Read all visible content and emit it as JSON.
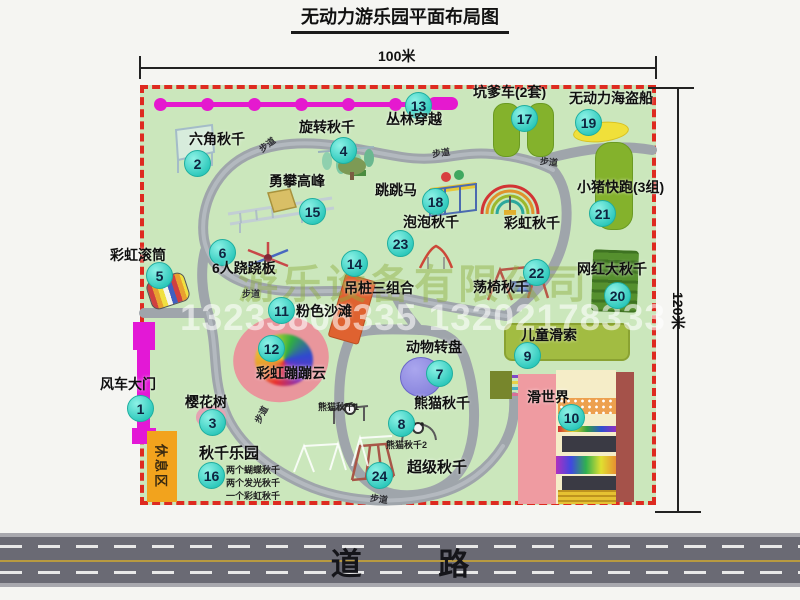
{
  "title": "无动力游乐园平面布局图",
  "dimensions": {
    "width": "100米",
    "height": "120米"
  },
  "road": {
    "label": "道 路"
  },
  "watermark": {
    "company": "游乐设备有限公司",
    "phone": "13233806335 13202178333"
  },
  "rest_area": {
    "label": "休息区"
  },
  "footpath_label": "步道",
  "items": {
    "i1": {
      "num": "1",
      "label": "风车大门"
    },
    "i2": {
      "num": "2",
      "label": "六角秋千"
    },
    "i3": {
      "num": "3",
      "label": "樱花树"
    },
    "i4": {
      "num": "4",
      "label": "旋转秋千"
    },
    "i5": {
      "num": "5",
      "label": "彩虹滚筒"
    },
    "i6": {
      "num": "6",
      "label": "6人跷跷板"
    },
    "i7": {
      "num": "7",
      "label": "动物转盘"
    },
    "i8": {
      "num": "8",
      "label": "熊猫秋千"
    },
    "i9": {
      "num": "9",
      "label": "儿童滑索"
    },
    "i10": {
      "num": "10",
      "label": "滑世界"
    },
    "i11": {
      "num": "11",
      "label": "粉色沙滩"
    },
    "i12": {
      "num": "12",
      "label": "彩虹蹦蹦云"
    },
    "i13": {
      "num": "13",
      "label": "丛林穿越"
    },
    "i14": {
      "num": "14",
      "label": "吊桩三组合"
    },
    "i15": {
      "num": "15",
      "label": "勇攀高峰"
    },
    "i16": {
      "num": "16",
      "label": "秋千乐园",
      "notes": [
        "两个蝴蝶秋千",
        "两个发光秋千",
        "一个彩虹秋千"
      ]
    },
    "i17": {
      "num": "17",
      "label": "坑爹车(2套)"
    },
    "i18": {
      "num": "18",
      "label": "跳跳马"
    },
    "i19": {
      "num": "19",
      "label": "无动力海盗船"
    },
    "i20": {
      "num": "20",
      "label": "网红大秋千"
    },
    "i21": {
      "num": "21",
      "label": "小猪快跑(3组)"
    },
    "i22": {
      "num": "22",
      "label": "荡椅秋千"
    },
    "i23": {
      "num": "23",
      "label": "泡泡秋千"
    },
    "i24": {
      "num": "24",
      "label": "超级秋千"
    }
  },
  "extra_labels": {
    "rainbow_swing": "彩虹秋千",
    "panda_swing_1": "熊猫秋千1",
    "panda_swing_2": "熊猫秋千2"
  },
  "colors": {
    "park_green": "#cbe7bc",
    "border_red": "#de2a20",
    "marker_teal": "#2cc8bb",
    "zipline_magenta": "#e519cf",
    "gate_magenta": "#e318d6",
    "rest_orange": "#f2a31d",
    "path_gray": "#9fa5ab",
    "road_gray": "#6a6a74"
  }
}
